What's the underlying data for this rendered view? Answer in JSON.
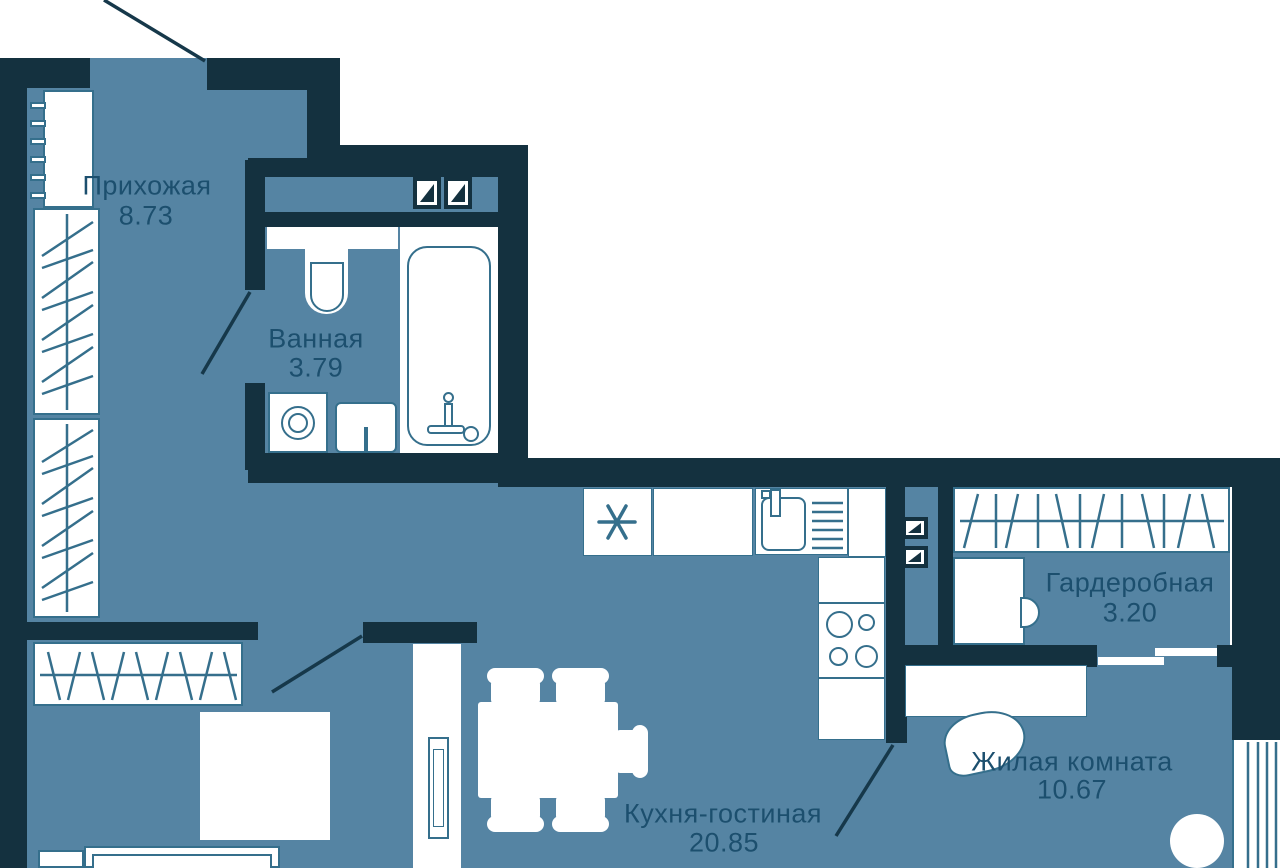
{
  "plan_title": "Apartment floor plan",
  "rooms": [
    {
      "id": "hallway",
      "name": "Прихожая",
      "area": "8.73"
    },
    {
      "id": "bathroom",
      "name": "Ванная",
      "area": "3.79"
    },
    {
      "id": "wardrobe",
      "name": "Гардеробная",
      "area": "3.20"
    },
    {
      "id": "kitchen_living",
      "name": "Кухня-гостиная",
      "area": "20.85"
    },
    {
      "id": "living_room",
      "name": "Жилая комната",
      "area": "10.67"
    }
  ],
  "colors": {
    "wall": "#14313f",
    "floor": "#5584a3",
    "fixture_outline": "#356f8c",
    "label_text": "#1c4f6e",
    "fixture_fill": "#ffffff",
    "outside": "#ffffff"
  },
  "fixtures": {
    "hallway": [
      "radiator",
      "wardrobe-closet",
      "wardrobe-closet",
      "hanging-rail-closet",
      "bed",
      "side-table"
    ],
    "bathroom": [
      "shelf",
      "toilet",
      "bathtub",
      "washing-machine",
      "sink",
      "vent-shaft",
      "vent-shaft"
    ],
    "kitchen_living": [
      "fridge",
      "countertop",
      "kitchen-sink",
      "hob",
      "dining-table",
      "chairs",
      "tv-stand",
      "tv"
    ],
    "wardrobe": [
      "hanging-rail",
      "cabinet"
    ],
    "living_room": [
      "desk",
      "desk-chair",
      "round-table",
      "radiator",
      "sliding-door",
      "vent-shaft",
      "vent-shaft"
    ]
  }
}
